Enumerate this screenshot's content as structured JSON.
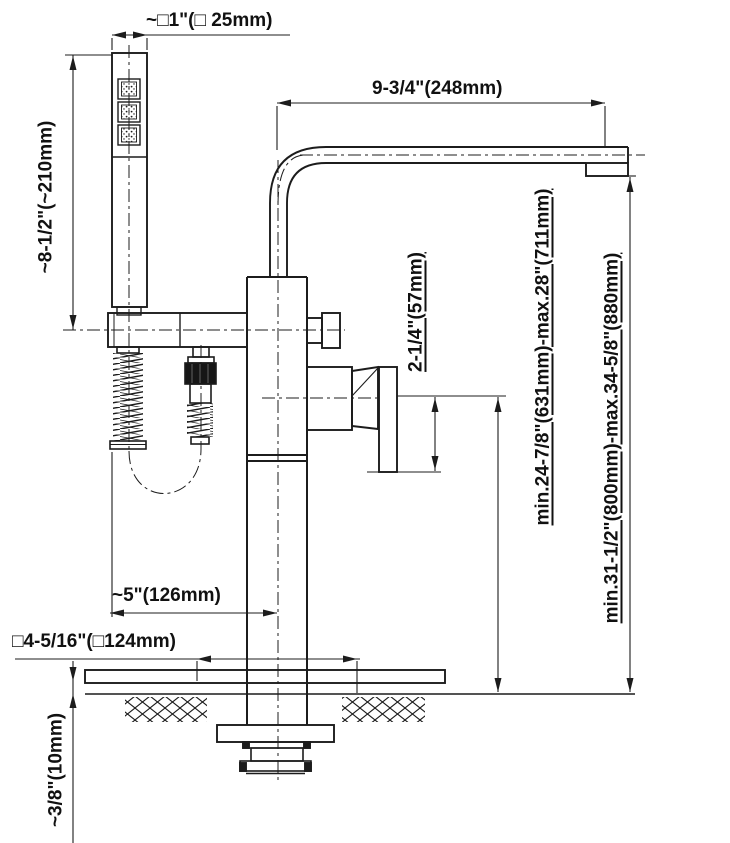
{
  "diagram": {
    "colors": {
      "line": "#1c1c1c",
      "background": "#ffffff"
    },
    "labels": {
      "hand_shower_width": "~□1\"(□ 25mm)",
      "spout_reach": "9-3/4\"(248mm)",
      "hand_shower_length": "~8-1/2\"(~210mm)",
      "handle_drop": "2-1/4\"(57mm)",
      "spout_height_range": "min.24-7/8\"(631mm)-max.28\"(711mm)",
      "total_height_range": "min.31-1/2\"(800mm)-max.34-5/8\"(880mm)",
      "column_offset": "~5\"(126mm)",
      "base_cutout_width": "□4-5/16\"(□124mm)",
      "floor_covering_thickness": "~3/8\"(10mm)"
    }
  }
}
